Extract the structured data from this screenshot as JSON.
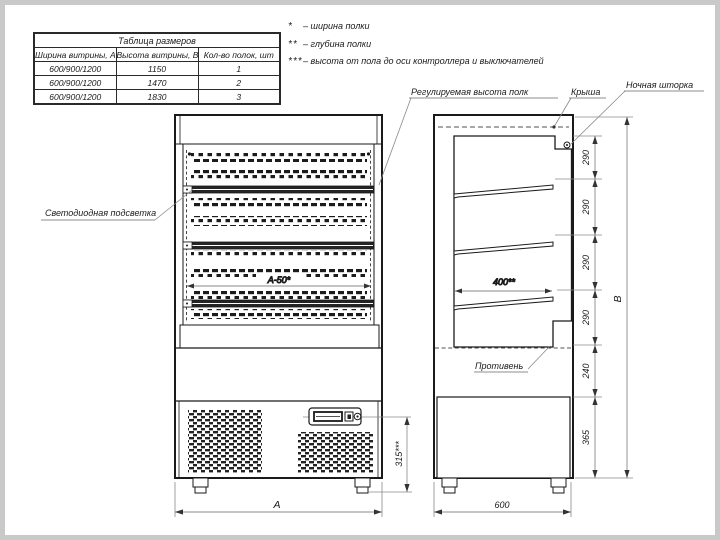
{
  "size_table": {
    "title": "Таблица размеров",
    "columns": [
      "Ширина витрины, А",
      "Высота витрины, В",
      "Кол-во полок, шт"
    ],
    "rows": [
      [
        "600/900/1200",
        "1150",
        "1"
      ],
      [
        "600/900/1200",
        "1470",
        "2"
      ],
      [
        "600/900/1200",
        "1830",
        "3"
      ]
    ]
  },
  "legend": {
    "items": [
      {
        "marker": "*",
        "text": "– ширина полки"
      },
      {
        "marker": "**",
        "text": "– глубина полки"
      },
      {
        "marker": "***",
        "text": "– высота от пола до оси контроллера и выключателей"
      }
    ]
  },
  "labels": {
    "shelf_height": "Регулируемая высота полк",
    "roof": "Крыша",
    "night_curtain": "Ночная шторка",
    "led": "Светодиодная подсветка",
    "tray": "Противень"
  },
  "dimensions": {
    "inner_width": "А-50*",
    "controller_height": "315***",
    "front_width": "А",
    "shelf_depth": "400**",
    "side_depth": "600",
    "total_height": "В",
    "right_chain": [
      "290",
      "290",
      "290",
      "290",
      "240",
      "365"
    ]
  },
  "colors": {
    "object_line": "#1a1a1a",
    "dimension_line": "#8a8a8a",
    "paper": "#ffffff",
    "frame": "#c9c9c9"
  }
}
